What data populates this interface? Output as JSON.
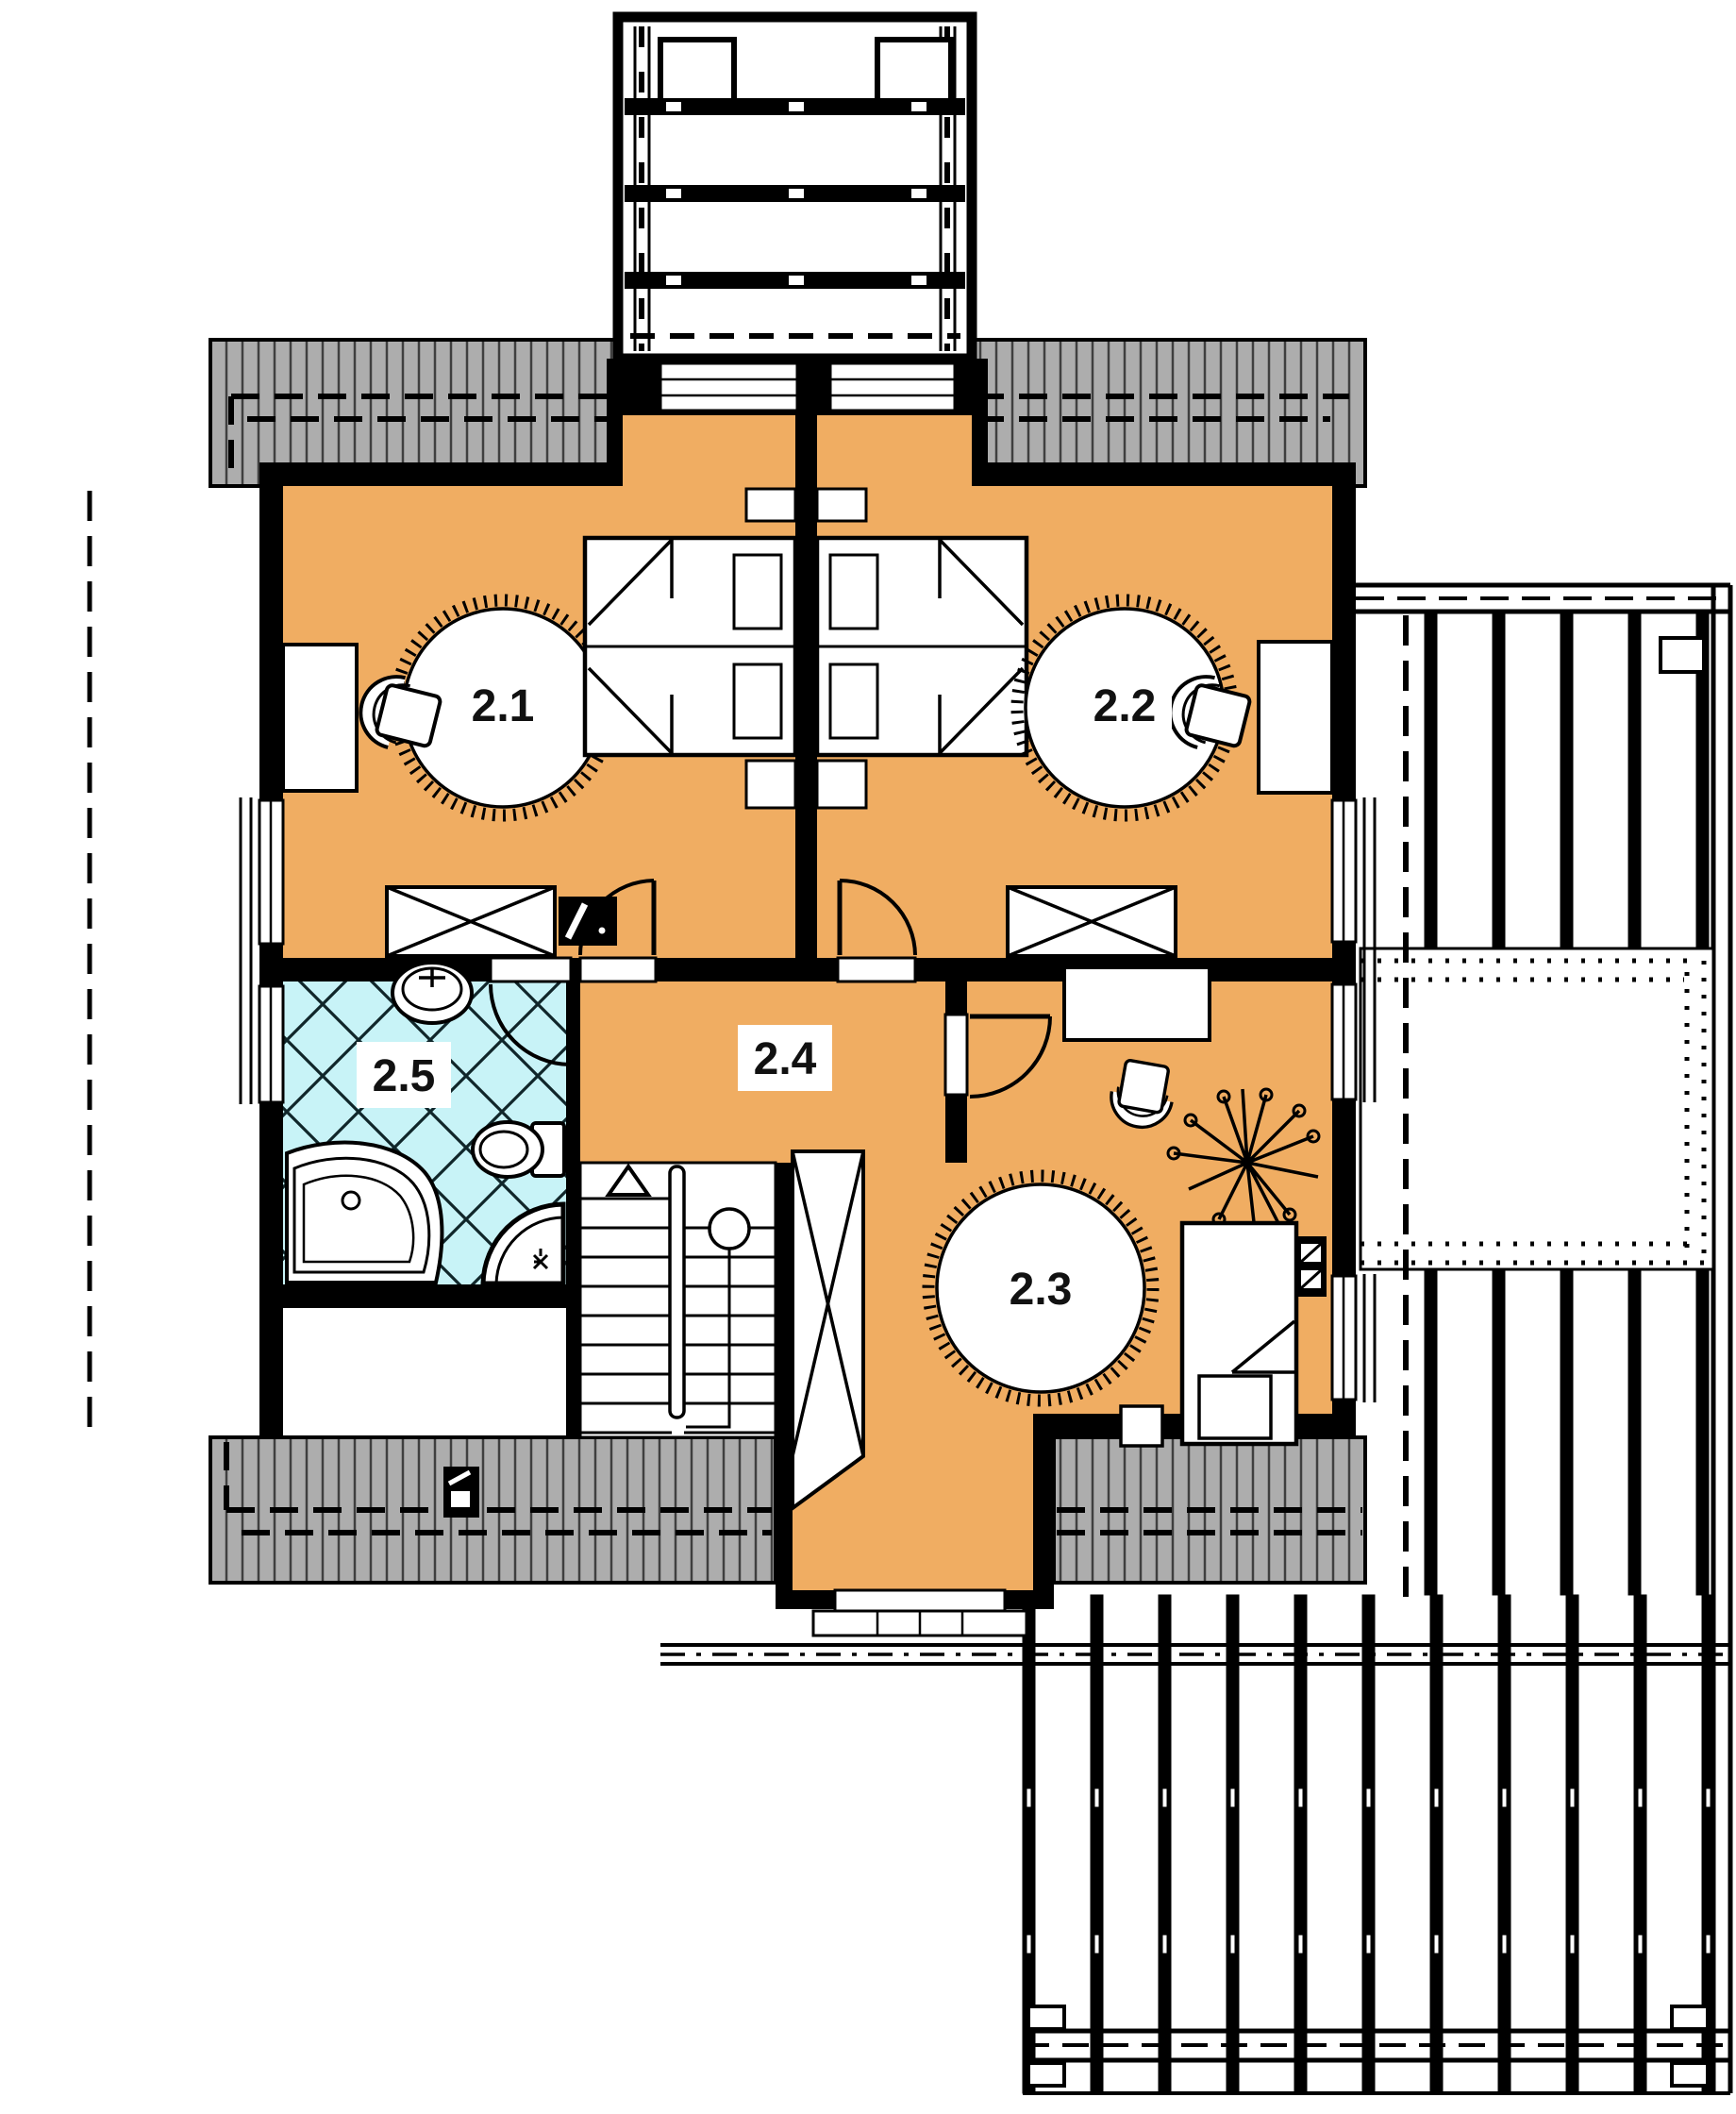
{
  "plan": {
    "type": "floor-plan",
    "storey_labels": [
      "2.1",
      "2.2",
      "2.3",
      "2.4",
      "2.5"
    ]
  },
  "rooms": [
    {
      "id": "room-2-1",
      "label": "2.1",
      "kind": "bedroom"
    },
    {
      "id": "room-2-2",
      "label": "2.2",
      "kind": "bedroom"
    },
    {
      "id": "room-2-3",
      "label": "2.3",
      "kind": "bedroom"
    },
    {
      "id": "room-2-4",
      "label": "2.4",
      "kind": "hall"
    },
    {
      "id": "room-2-5",
      "label": "2.5",
      "kind": "bathroom"
    }
  ],
  "colors": {
    "floor": "#F0AD62",
    "tile": "#C8F3F7",
    "roof": "#ADADAD",
    "roof_hatch": "#3F3F3F",
    "wall": "#000000",
    "paper": "#FFFFFF"
  }
}
